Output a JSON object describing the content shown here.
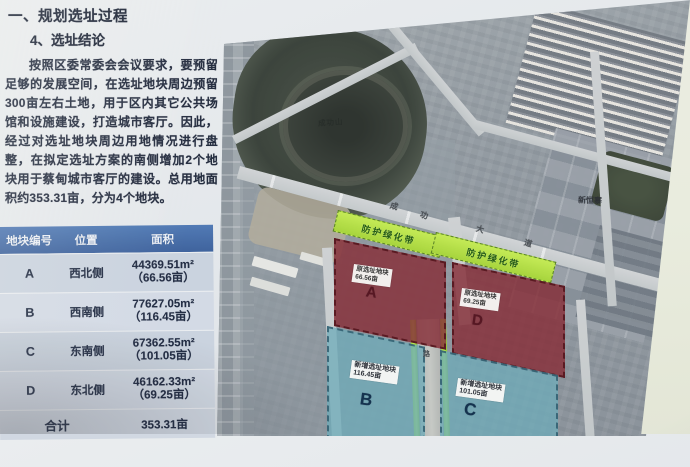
{
  "slide": {
    "section_title": "一、规划选址过程",
    "subsection_title": "4、选址结论",
    "paragraph": "按照区委常委会会议要求，要预留足够的发展空间，在选址地块周边预留300亩左右土地，用于区内其它公共场馆和设施建设，打造城市客厅。因此，经过对选址地块周边用地情况进行盘整，在拟定选址方案的南侧增加2个地块用于蔡甸城市客厅的建设。总用地面积约353.31亩，分为4个地块。"
  },
  "table": {
    "headers": [
      "地块编号",
      "位置",
      "面积"
    ],
    "rows": [
      {
        "id": "A",
        "location": "西北侧",
        "area_m2": "44369.51m²",
        "area_mu": "（66.56亩）"
      },
      {
        "id": "B",
        "location": "西南侧",
        "area_m2": "77627.05m²",
        "area_mu": "（116.45亩）"
      },
      {
        "id": "C",
        "location": "东南侧",
        "area_m2": "67362.55m²",
        "area_mu": "（101.05亩）"
      },
      {
        "id": "D",
        "location": "东北侧",
        "area_m2": "46162.33m²",
        "area_mu": "（69.25亩）"
      }
    ],
    "total_label": "合计",
    "total_value": "353.31亩"
  },
  "map": {
    "belt1_label": "防护绿化带",
    "belt2_label": "防护绿化带",
    "road_name_chars": [
      "成",
      "功",
      "大",
      "道"
    ],
    "vertical_road_char": "路",
    "hill_label": "成功山",
    "place_label": "新恒寨",
    "parcel_a": {
      "tag": "原选址地块",
      "area": "66.56亩",
      "letter": "A"
    },
    "parcel_d": {
      "tag": "原选址地块",
      "area": "69.25亩",
      "letter": "D"
    },
    "parcel_b": {
      "tag": "新增选址地块",
      "area": "116.45亩",
      "letter": "B"
    },
    "parcel_c": {
      "tag": "新增选址地块",
      "area": "101.05亩",
      "letter": "C"
    }
  },
  "colors": {
    "table_header_bg": "#3f6cb0",
    "belt_green": "#b5e43c",
    "parcel_red": "#8c2934",
    "parcel_teal": "#68aebd",
    "slide_bg": "#e6eaed",
    "wall_edge": "#edefe0"
  }
}
